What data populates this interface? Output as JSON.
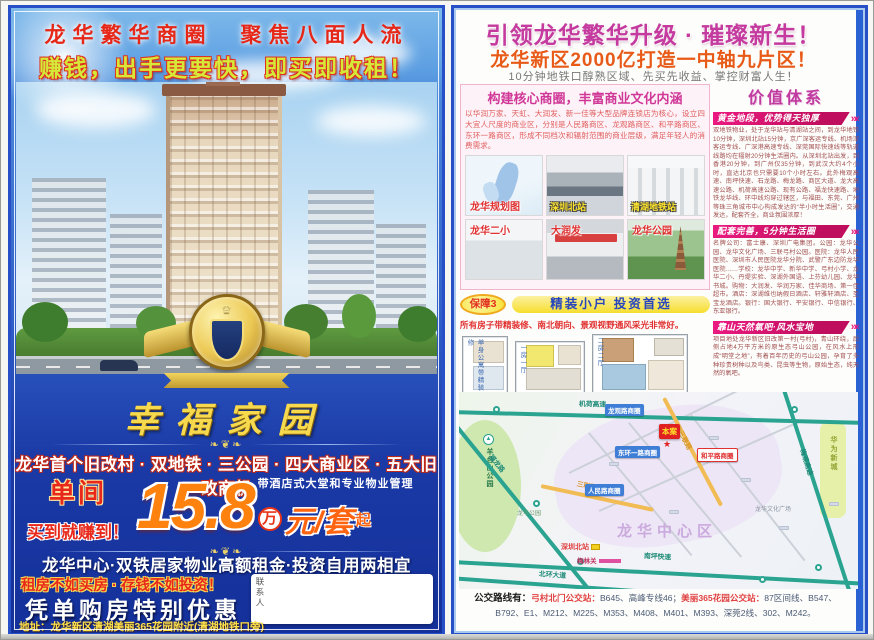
{
  "palette": {
    "page_blue": "#1b3aa6",
    "frame_blue": "#2750c8",
    "gold": "#f7d94e",
    "magenta": "#c43a9e",
    "banner_pink": "#ea1a80",
    "price_orange": "#ff820f",
    "road_teal": "#2aa390",
    "road_orange": "#f2bc54",
    "caption_yellow": "#ffe42a",
    "alert_red": "#e03030"
  },
  "left_page": {
    "banner_title": "龙华繁华商圈　聚焦八面人流",
    "subtitle": "赚钱，出手更要快，即买即收租！",
    "emblem_name": "幸福家园",
    "ornament": "❧❦❧",
    "selling_points": "龙华首个旧改村 · 双地铁 · 三公园 · 四大商业区 · 五大旧改商机",
    "price": {
      "room_type": "单间",
      "slogan": "买到就赚到！",
      "number": "15.8",
      "wan": "万",
      "unit": "元/套",
      "qi": "起",
      "note": "带酒店式大堂和专业物业管理"
    },
    "line2": "龙华中心·双铁居家物业高额租金·投资自用两相宜",
    "line3": "租房不如买房 · 存钱不如投资！",
    "offer": "凭单购房特别优惠",
    "contact_label": "联系人",
    "address": "地址：龙华新区清湖美丽365花园附近(清湖地铁口旁)"
  },
  "right_page": {
    "title": "引领龙华繁华升级 · 璀璨新生！",
    "subtitle": "龙华新区2000亿打造一中轴九片区！",
    "tagline": "10分钟地铁口醇熟区域、先买先收益、掌控财富人生！",
    "business_box": {
      "title": "构建核心商圈，丰富商业文化内涵",
      "body": "以华润万家、天虹、大润发、新一佳等大型品牌连锁店为核心，设立四大宜人尺度的商业区，分别是人民路商区、龙观路商区、和平路商区、东环一路商区，形成不同档次和辐射范围的商业层级，满足年轻人的消费需求。",
      "photos": [
        {
          "label": "龙华规划图"
        },
        {
          "label": "深圳北站"
        },
        {
          "label": "清湖地铁站"
        },
        {
          "label": "龙华二小"
        },
        {
          "label": "大润发"
        },
        {
          "label": "龙华公园"
        }
      ]
    },
    "guarantee": {
      "badge": "保障3",
      "title": "精装小户 投资首选",
      "desc": "所有房子带精装修、南北朝向、景观视野通风采光非常好。",
      "plans": [
        {
          "label": "单身公寓带精装修"
        },
        {
          "label": "一房一厅"
        },
        {
          "label": "二房二厅"
        }
      ]
    },
    "value_system": {
      "title": "价值体系",
      "arrows": "»»",
      "sections": [
        {
          "banner": "黄金地段，优势得天独厚",
          "body": "双地铁物业，处于龙华站与清湖站之间，到龙华地铁10分钟，深圳北站15分钟，京广深客运专线、机场深客运专线、广深港高速专线、深莞国际快速线等轨道线路均在辐射20分钟生活圈内。从深圳北站出发，到香港20分钟，到广州仅35分钟，到武汉大约4个小时，直达北京也只需要10个小时左右。此外梅观高速、南坪快速、石龙路、梅龙路、商区大道、龙大高速公路、机荷高速公路、现有公路、福龙快速路、地铁龙华线、环中线均穿过辖区，与福田、东莞、广州等珠三角城市中心构成发达的“半小时生活圈”，交通发达，配套齐全，商业氛围浓厚！"
        },
        {
          "banner": "配套完善，5分钟生活圈",
          "body": "名牌公司：富士康、深圳广电集团。公园：龙华公园、龙华文化广场、三联弓村公园。医院：龙华人民医院、深圳市人民医院龙华分院、武警广东边防龙华医院……学校：龙华中学、新华中学、弓村小学、龙华二小、丹堤实验、深湖外国语、上芬幼儿园、龙华书城。购物：大润发、华润万家、佳华商场、第一佳超市。酒店：深湖维也纳假日酒店、轩雅轩酒店、圣宝龙酒店。银行：国大银行、平安银行、中信银行、东亚银行。"
        },
        {
          "banner": "靠山天然氧吧·风水宝地",
          "body": "项目地处龙华新区旧改第一村(弓村)，青山环绕，后侧占地4万平方米的原生态弓山公园，在风水上形成“明堂之地”，有着百年历史的弓山公园，孕育了多种珍贵树种以及鸟类、昆虫等生物，原始生态，纯天然的氧吧。"
        }
      ]
    },
    "map": {
      "jihe_expwy": "机荷高速",
      "meiguan_expwy": "梅观高速",
      "fulong_rd": "福龙路",
      "nanping_expwy": "南坪快速",
      "beihuan_ave": "北环大道",
      "sanlian_rd": "三联路",
      "yangtaishan": "羊台山公园",
      "huawei": "华为新城",
      "zone_longguan": "龙观路商圈",
      "zone_donghuan": "东环一路商圈",
      "zone_heping": "和平路商圈",
      "zone_renmin": "人民路商圈",
      "project": "本案",
      "project_star": "★",
      "center": "龙华中心区",
      "north_station": "深圳北站",
      "meilinguan": "梅林关",
      "culture_square": "龙华文化广场",
      "longhua_park": "龙华公园",
      "park_icon": "▲"
    },
    "bus": {
      "prefix": "公交路线有：",
      "station1": "弓村北门公交站：",
      "routes1": "B645、高峰专线46；",
      "station2": "美丽365花园公交站：",
      "routes2": "87区间线、B547、B792、E1、M212、M225、M353、M408、M401、M393、深莞2线、302、M242。"
    }
  }
}
